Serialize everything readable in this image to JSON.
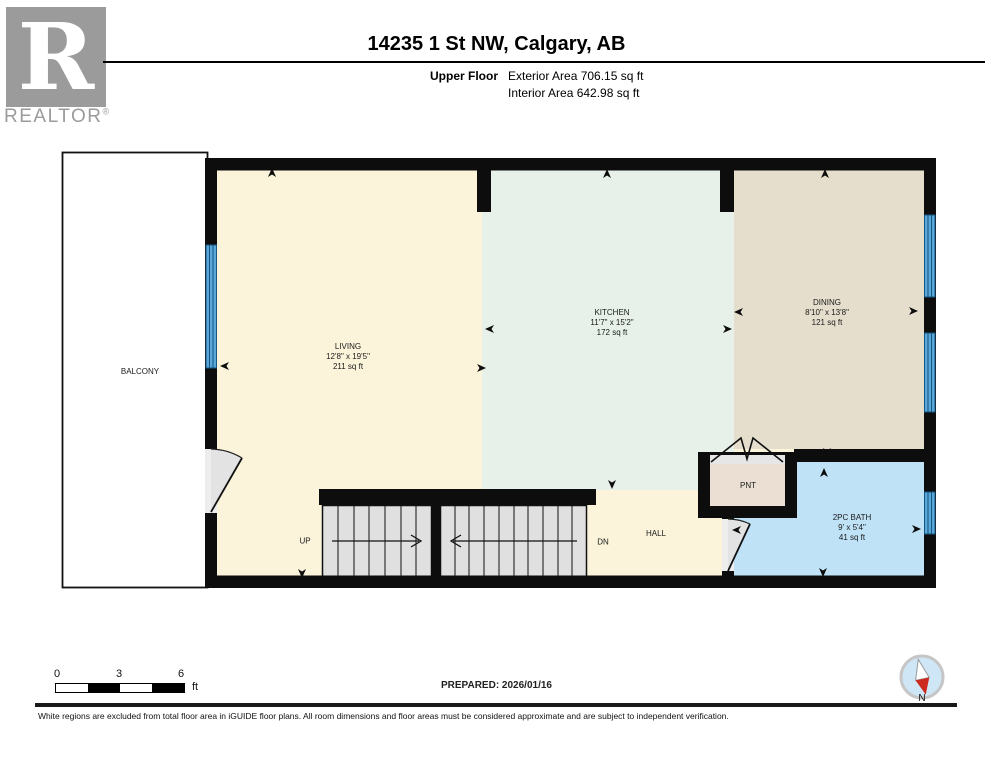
{
  "header": {
    "logo_letter": "R",
    "brand": "REALTOR",
    "registered": "®",
    "title": "14235 1 St NW, Calgary, AB",
    "floor_label": "Upper Floor",
    "exterior_area": "Exterior Area 706.15 sq ft",
    "interior_area": "Interior Area 642.98 sq ft"
  },
  "plan": {
    "rooms": {
      "balcony": {
        "label": "BALCONY"
      },
      "living": {
        "label": "LIVING",
        "dims": "12'8\" x 19'5\"",
        "area": "211 sq ft"
      },
      "kitchen": {
        "label": "KITCHEN",
        "dims": "11'7\" x 15'2\"",
        "area": "172 sq ft"
      },
      "dining": {
        "label": "DINING",
        "dims": "8'10\" x 13'8\"",
        "area": "121 sq ft"
      },
      "bath": {
        "label": "2PC BATH",
        "dims": "9' x 5'4\"",
        "area": "41 sq ft"
      },
      "pantry": {
        "label": "PNT"
      },
      "hall": {
        "label": "HALL"
      }
    },
    "stairs": {
      "up": "UP",
      "dn": "DN"
    },
    "colors": {
      "living": "#FBF4DB",
      "kitchen": "#E7F1EA",
      "dining": "#E5DECC",
      "bath": "#BFE2F7",
      "pantry": "#EADFD2",
      "window": "#5AA8D9",
      "window_line": "#16557F",
      "wall": "#0d0d0d",
      "stair": "#E0E0E0",
      "compass_red": "#CC2A1E",
      "compass_fill": "#CFE6F7"
    }
  },
  "footer": {
    "scale": {
      "t0": "0",
      "t3": "3",
      "t6": "6",
      "unit": "ft"
    },
    "prepared": "PREPARED: 2026/01/16",
    "compass_label": "N",
    "disclaimer": "White regions are excluded from total floor area in iGUIDE floor plans. All room dimensions and floor areas must be considered approximate and are subject to independent verification."
  }
}
